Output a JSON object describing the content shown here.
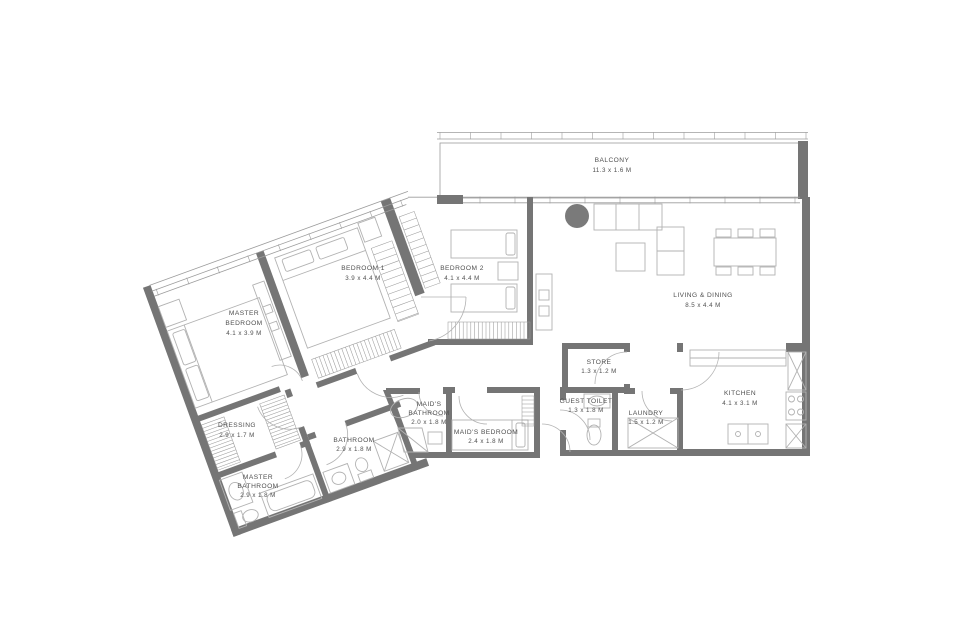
{
  "colors": {
    "wall": "#757575",
    "line": "#9c9c9c",
    "furniture": "#b2b2b2",
    "text": "#4f4f4f",
    "column": "#7a7a7a",
    "background": "#ffffff"
  },
  "rooms": {
    "balcony": {
      "name": "BALCONY",
      "dims": "11.3 x 1.6 M"
    },
    "living": {
      "name": "LIVING & DINING",
      "dims": "8.5 x 4.4 M"
    },
    "kitchen": {
      "name": "KITCHEN",
      "dims": "4.1 x 3.1 M"
    },
    "store": {
      "name": "STORE",
      "dims": "1.3 x 1.2 M"
    },
    "guest_toilet": {
      "name": "GUEST TOILET",
      "dims": "1.3 x 1.8 M"
    },
    "laundry": {
      "name": "LAUNDRY",
      "dims": "1.5 x 1.2 M"
    },
    "maids_bedroom": {
      "name": "MAID'S BEDROOM",
      "dims": "2.4 x 1.8 M"
    },
    "maids_bathroom": {
      "line1": "MAID'S",
      "line2": "BATHROOM",
      "dims": "2.0 x 1.8 M"
    },
    "bedroom2": {
      "name": "BEDROOM 2",
      "dims": "4.1 x 4.4 M"
    },
    "bedroom1": {
      "name": "BEDROOM 1",
      "dims": "3.9 x 4.4 M"
    },
    "master_bedroom": {
      "line1": "MASTER",
      "line2": "BEDROOM",
      "dims": "4.1 x 3.9 M"
    },
    "dressing": {
      "name": "DRESSING",
      "dims": "2.9 x 1.7 M"
    },
    "bathroom": {
      "name": "BATHROOM",
      "dims": "2.9 x 1.8 M"
    },
    "master_bathroom": {
      "line1": "MASTER",
      "line2": "BATHROOM",
      "dims": "2.9 x 1.8 M"
    }
  }
}
